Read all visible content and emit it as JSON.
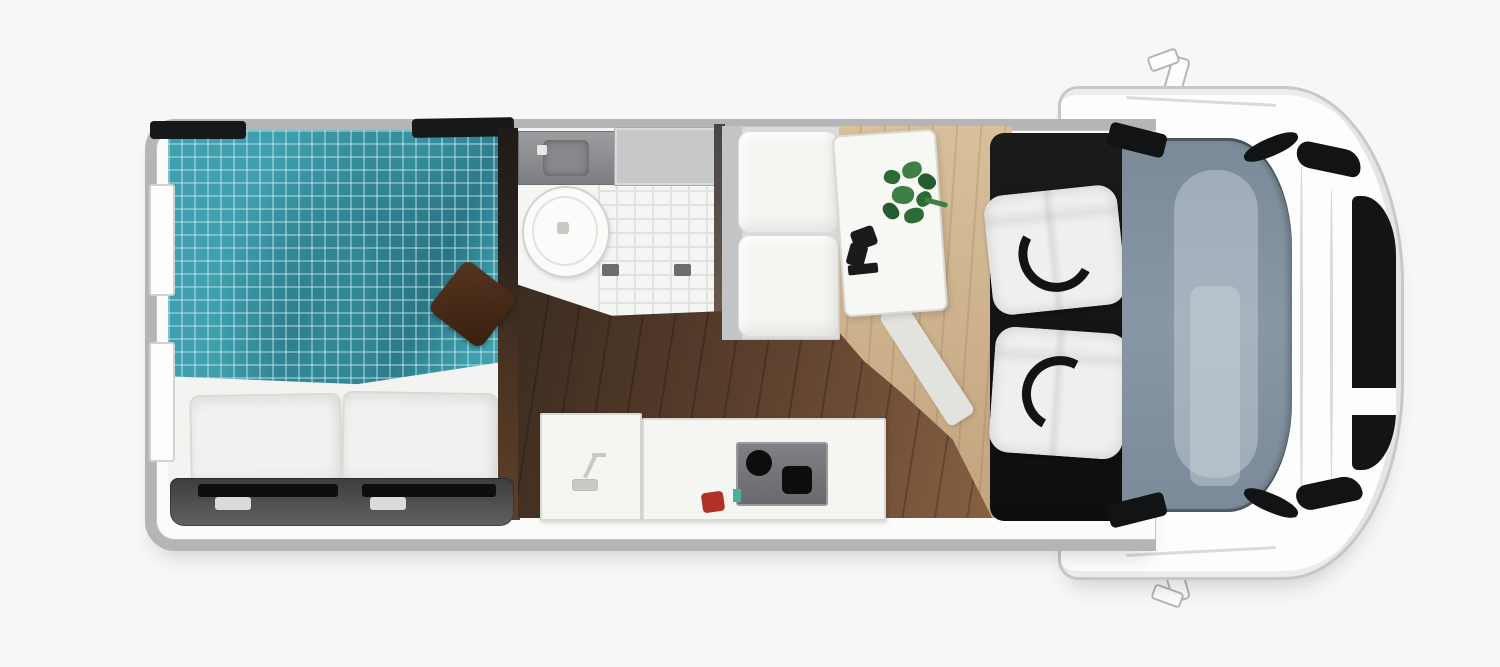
{
  "app": {
    "type": "floor-plan-illustration",
    "subject": "motorhome-camper-van-top-view",
    "orientation": "front-of-vehicle-to-the-right"
  },
  "zones": {
    "bedroom_rear": [
      "double-bed",
      "teal-checked-duvet",
      "pillow-left",
      "pillow-right",
      "brown-throw-cushion",
      "rear-garage-hatch",
      "two-rear-wall-windows"
    ],
    "bathroom": [
      "sink-counter",
      "toilet",
      "tiled-shower-floor",
      "wall-cabinet"
    ],
    "kitchen": [
      "sink-counter-with-faucet",
      "worktop",
      "two-burner-hob",
      "red-utensil"
    ],
    "dinette": [
      "bench-seat-two-cushions",
      "table",
      "green-plant",
      "dark-tableware"
    ],
    "cab_front": [
      "swivel-seat-top",
      "swivel-seat-bottom",
      "dashboard-windshield",
      "side-mirror-top",
      "side-mirror-bottom",
      "hood",
      "front-grille"
    ]
  },
  "colors": {
    "canvas_bg": "#f7f7f8",
    "wall": "#b4b5b7",
    "body_white": "#fdfdfd",
    "outline": "#c6c7c9",
    "interior": "#fbfbfa",
    "trim_black": "#17181a",
    "teal": "#3f9fae",
    "teal_grid": "#d2f2f666",
    "teal_shadow": "#0c3e5059",
    "sheet": "#f3f3f1",
    "pillow": "#f1f1ef",
    "pillow_line": "#d9d9d6",
    "cushion_a": "#56361f",
    "cushion_b": "#371f10",
    "garage_a": "#606163",
    "garage_b": "#3c3d3f",
    "slot_black": "#0e0e0f",
    "handle": "#dadada",
    "counter_dark_a": "#9b9da0",
    "counter_dark_b": "#7c7e81",
    "cabinet": "#c7c8ca",
    "tile": "#f5f5f4",
    "tile_line": "#e2e2e1",
    "wood_a": "#3c2c20",
    "wood_b": "#5a3e2c",
    "wood_c": "#8a6244",
    "wood_line": "#00000038",
    "tan_a": "#d8c09c",
    "tan_b": "#c2a47e",
    "tan_line": "#785a2d2e",
    "furn_white": "#f5f5f2",
    "furn_line": "#d8d8d4",
    "hob_a": "#7e8083",
    "hob_b": "#686a6d",
    "burner": "#0d0d0d",
    "red": "#b23028",
    "teal_accent": "#4fae9e",
    "green_a": "#2d6b36",
    "green_b": "#3f7f46",
    "green_c": "#255c2e",
    "mat_a": "#1b1b1c",
    "mat_b": "#0e0e0f",
    "seat_white": "#efefed",
    "ws_a": "#7b8a99",
    "ws_b": "#8897a6",
    "ws_light": "#cdd5dc73",
    "grille": "#141417",
    "steel_dark": "#121315"
  }
}
